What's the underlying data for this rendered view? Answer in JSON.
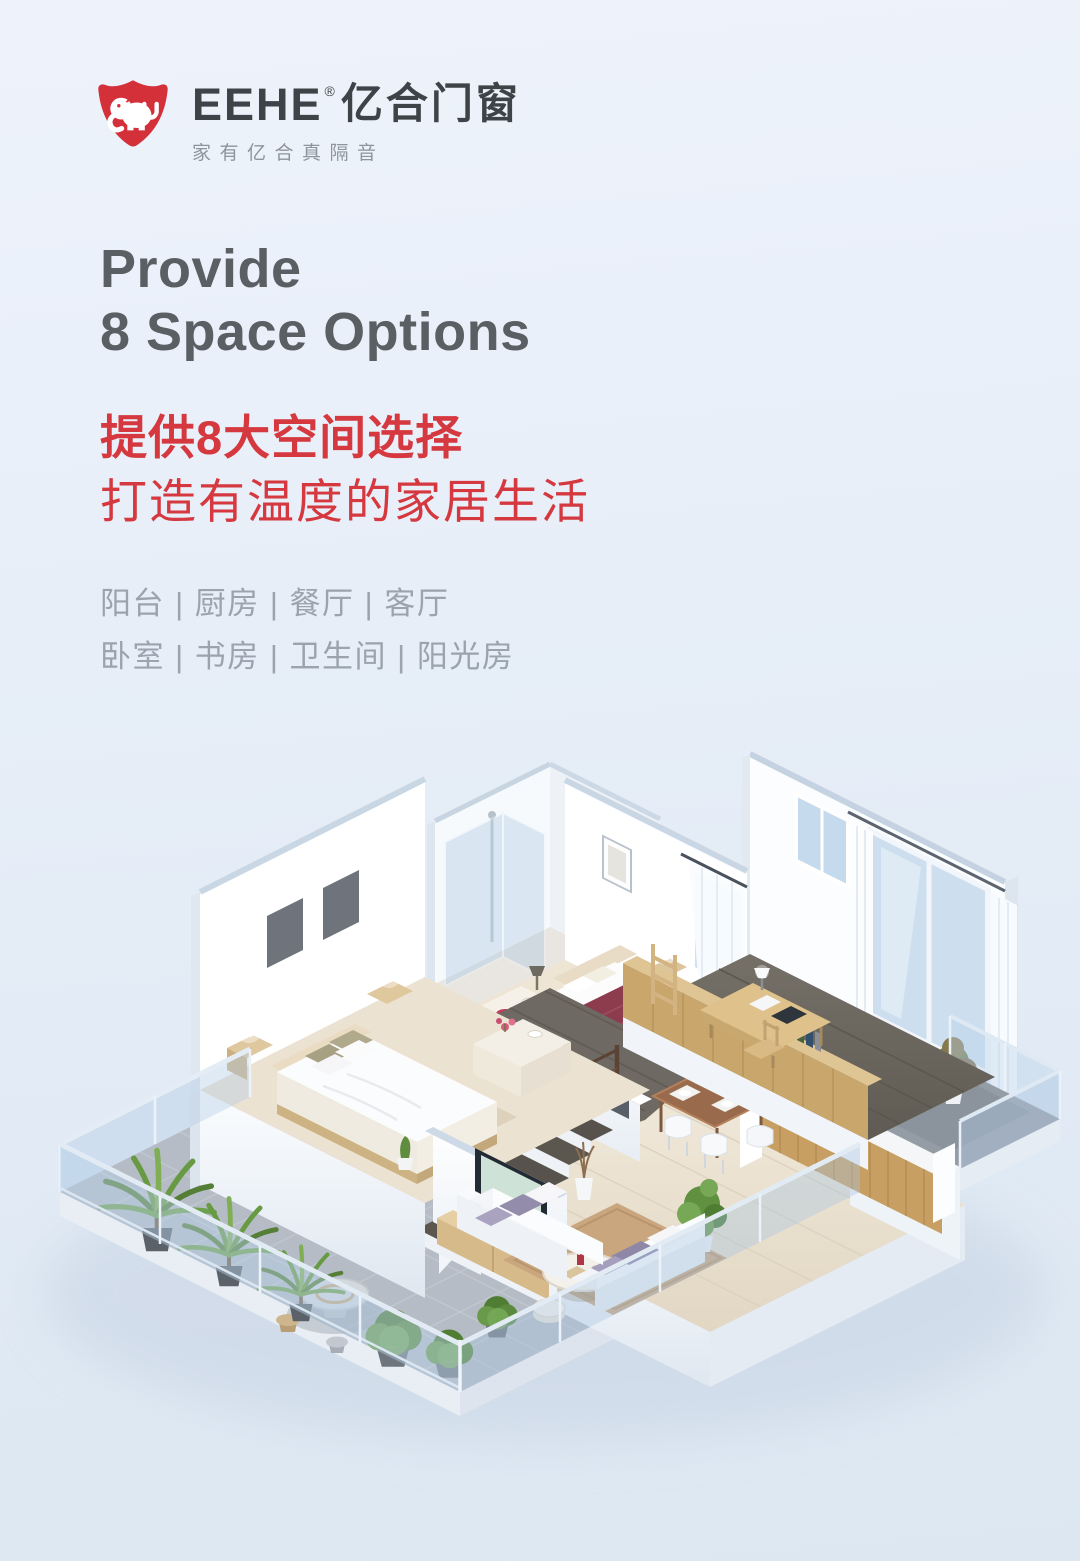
{
  "page": {
    "width": 1080,
    "height": 1561,
    "background_top": "#edf2fa",
    "background_bottom": "#dde8f3"
  },
  "logo": {
    "brand": "EEHE",
    "registered_mark": "®",
    "brand_cn": "亿合门窗",
    "tagline": "家有亿合真隔音",
    "shield_color": "#d4303a",
    "text_color": "#3d4347",
    "tagline_color": "#8d949e"
  },
  "headline": {
    "line1": "Provide",
    "line2": "8 Space Options",
    "color": "#5a5f64"
  },
  "subheadline": {
    "line1": "提供8大空间选择",
    "line2": "打造有温度的家居生活",
    "color": "#d5383f"
  },
  "rooms": {
    "row1": "阳台 | 厨房 | 餐厅 | 客厅",
    "row2": "卧室 | 书房 | 卫生间 | 阳光房",
    "color": "#9aa3ae"
  },
  "illustration": {
    "type": "isometric-apartment-3d-render",
    "rooms_depicted": [
      "阳台",
      "厨房",
      "餐厅",
      "客厅",
      "卧室",
      "书房",
      "卫生间",
      "阳光房"
    ],
    "palette": {
      "wall_white": "#ffffff",
      "wall_cut_top": "#c9d6e4",
      "floor_light_wood": "#ece3d3",
      "floor_dark_wood": "#6e6a62",
      "terrace_tile": "#b5bcc5",
      "railing_glass": "#b7cfe7",
      "furniture_wood": "#c9a76c",
      "bed_accent": "#8c3c4c",
      "plant_green": "#5d8f3c"
    }
  }
}
